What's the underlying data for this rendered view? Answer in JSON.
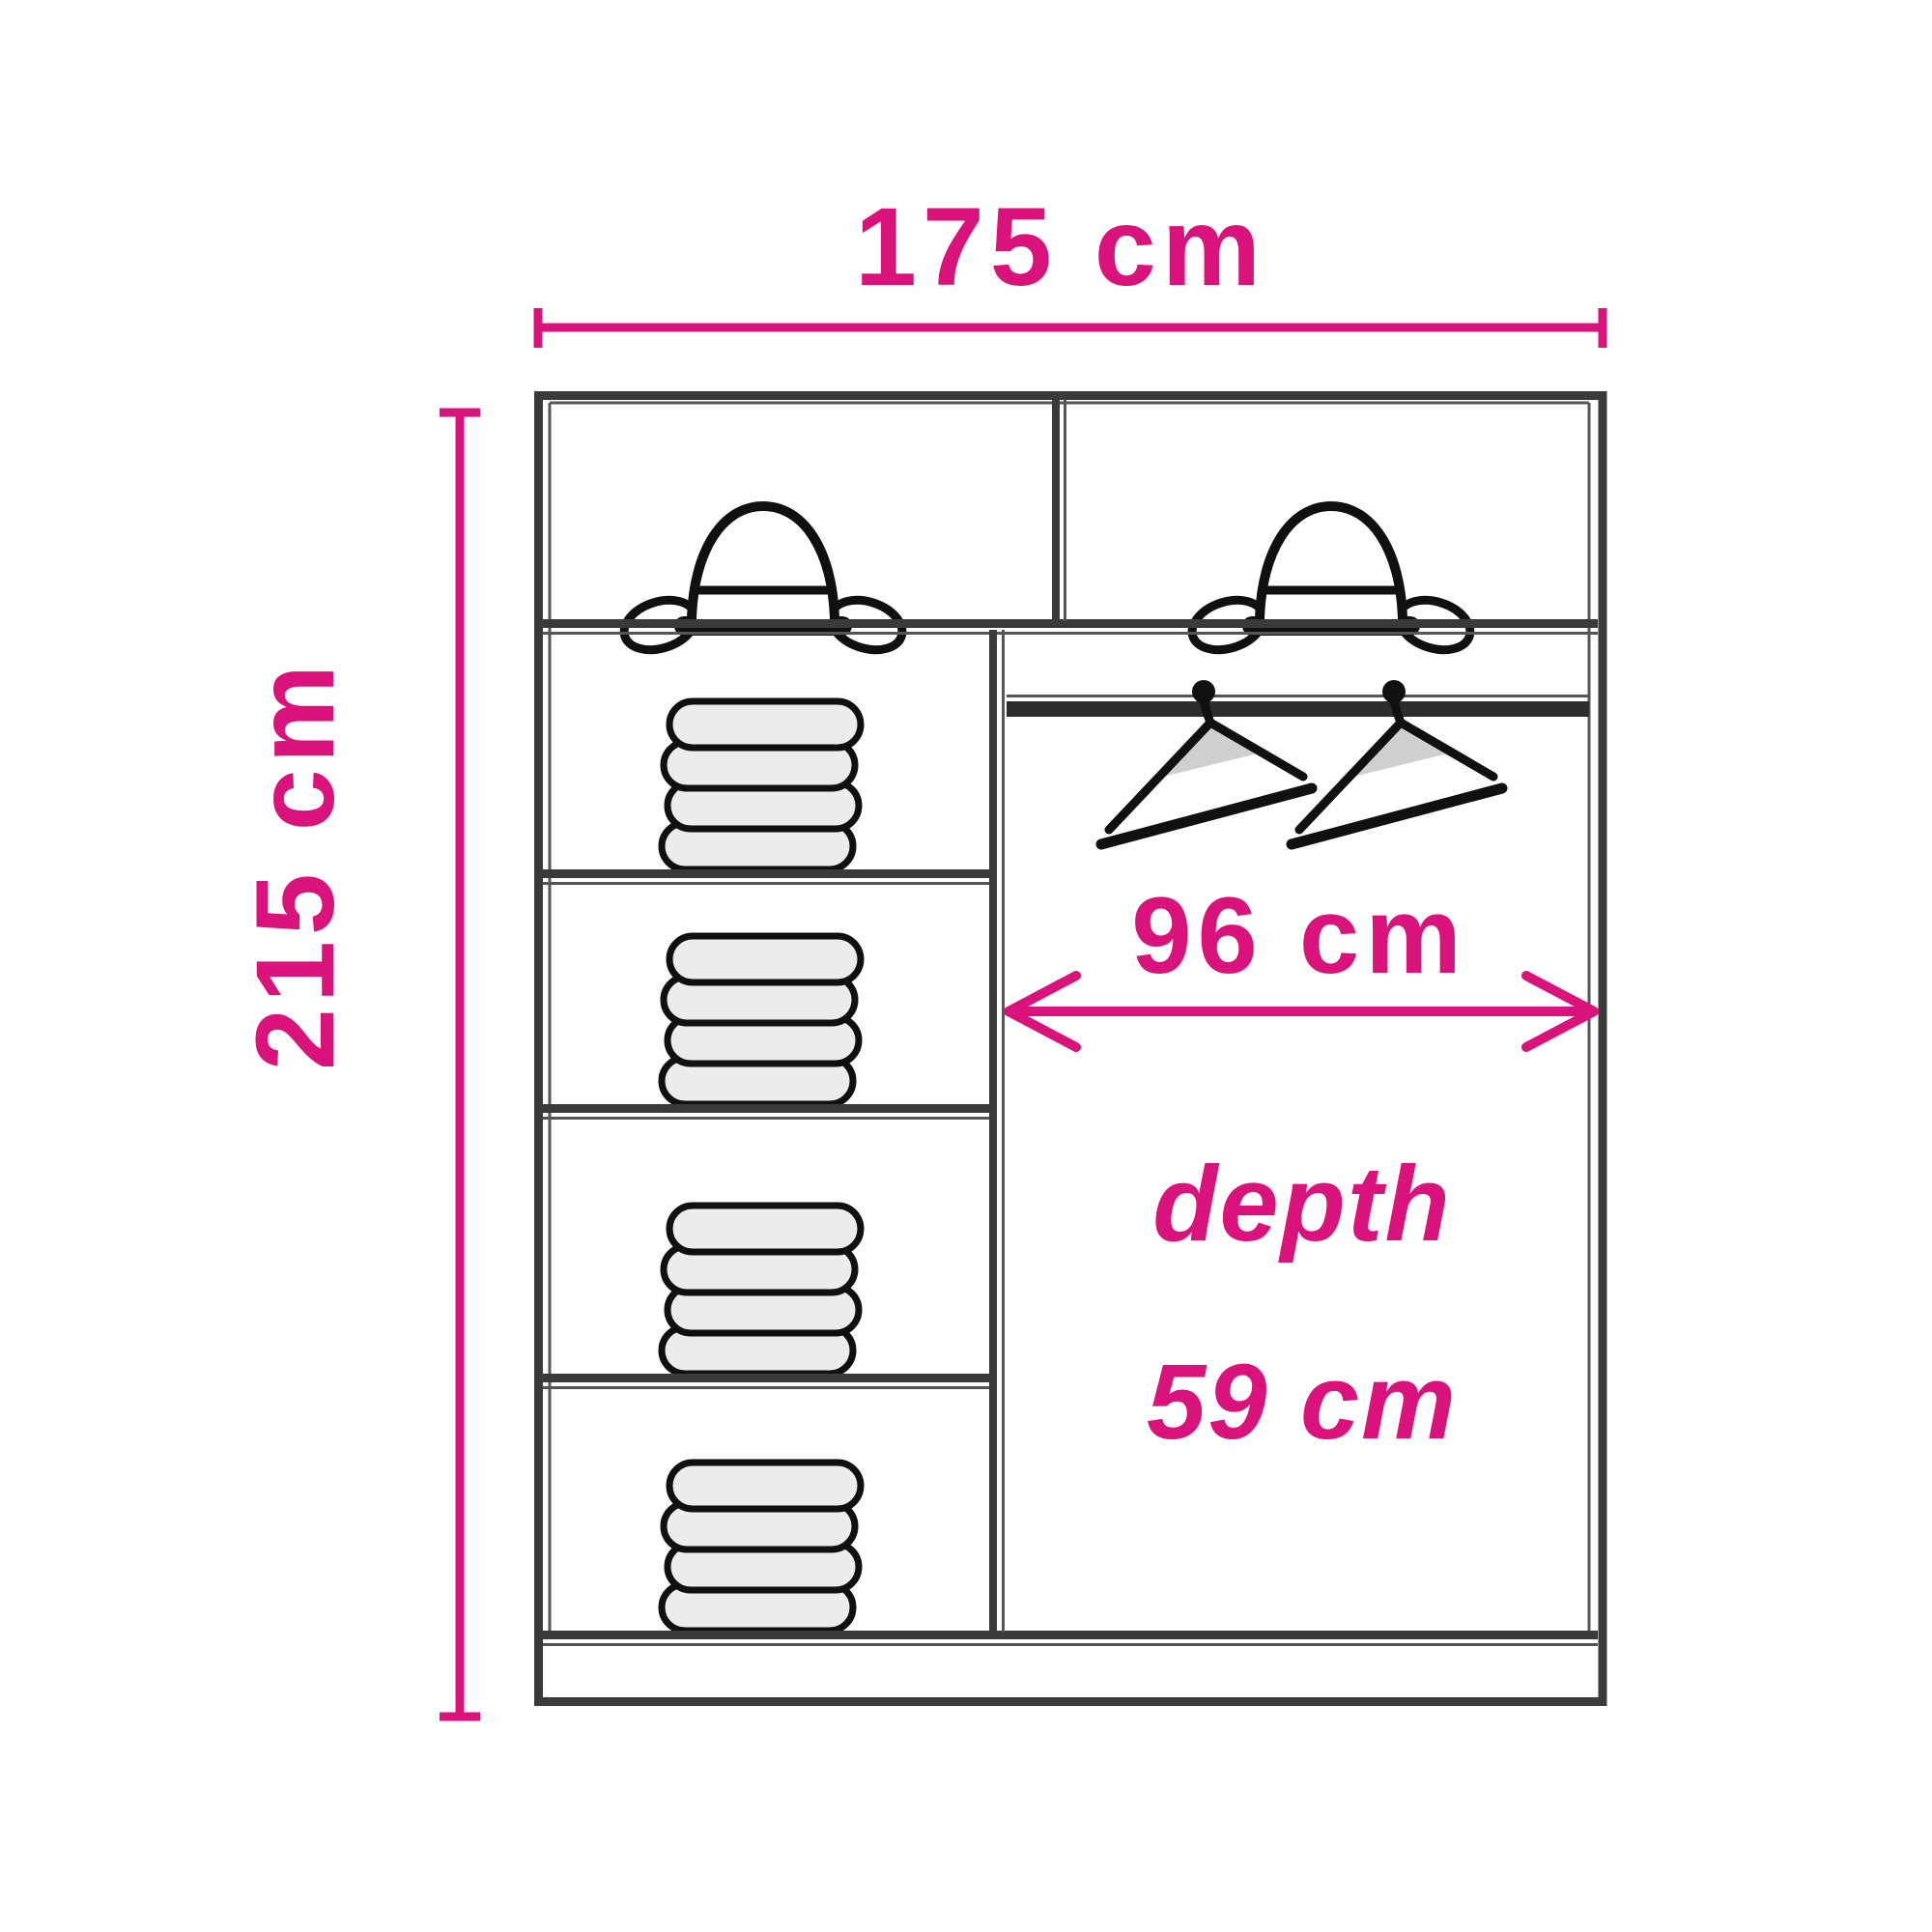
{
  "diagram": {
    "type": "wardrobe-interior-dimension-diagram",
    "width_label": "175 cm",
    "height_label": "215 cm",
    "inner_width_label": "96 cm",
    "depth_word_label": "depth",
    "depth_value_label": "59 cm",
    "colors": {
      "dimension_pink": "#d9137b",
      "outline_dark": "#3a3a3a",
      "inner_line": "#555555",
      "icon_stroke": "#101010",
      "towel_fill": "#ececec",
      "hanger_shade_fill": "#cfcfcf",
      "background": "#ffffff"
    },
    "contents": {
      "hat_count": 2,
      "towel_stack_count": 4,
      "towels_per_stack": 4,
      "hanger_count": 2
    },
    "icons": [
      "bowler-hat-icon",
      "folded-towel-stack-icon",
      "clothes-hanger-icon"
    ]
  }
}
